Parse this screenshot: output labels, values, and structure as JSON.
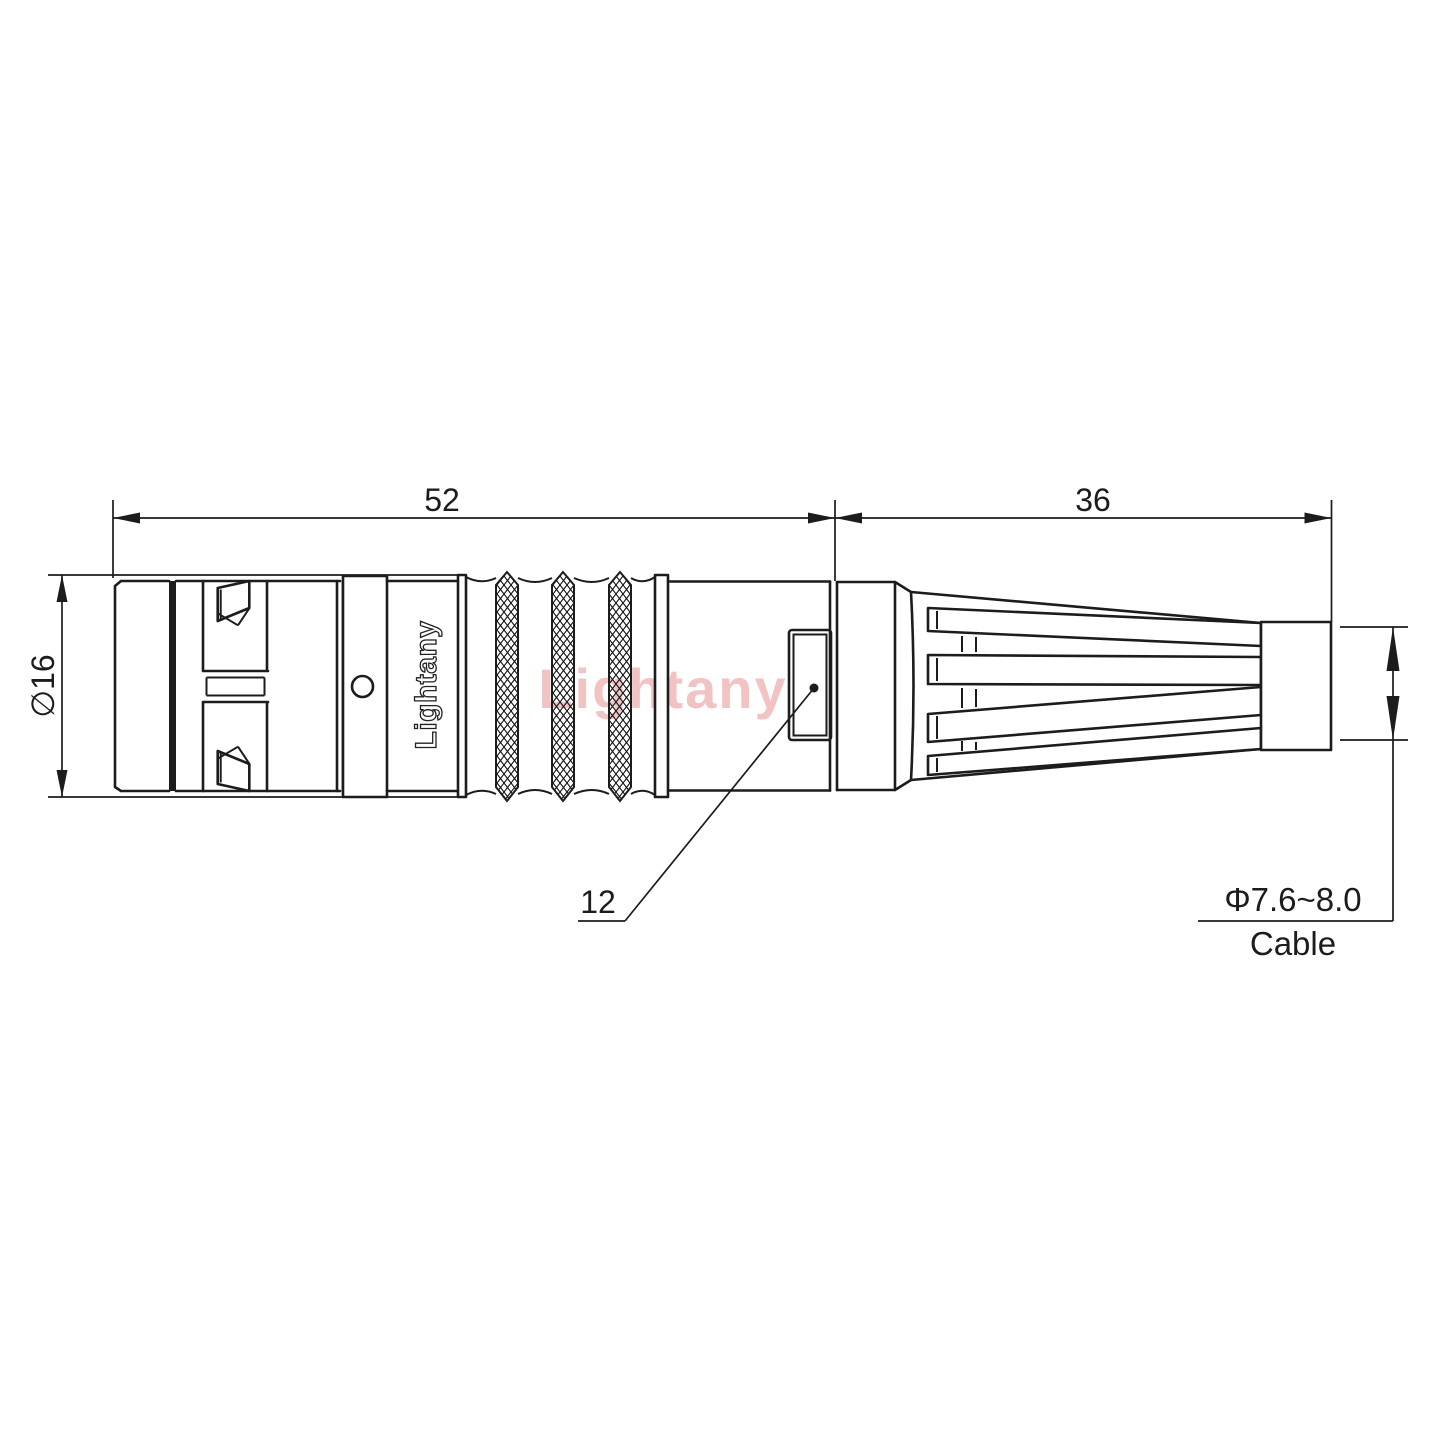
{
  "drawing": {
    "type": "connector-technical-drawing",
    "dims": {
      "front_length": "52",
      "boot_length": "36",
      "diameter": "∅16",
      "insert": "12",
      "cable_diameter": "Φ7.6~8.0",
      "cable_word": "Cable"
    },
    "brand": {
      "marking": "Lightany",
      "watermark": "Lightany"
    },
    "colors": {
      "line": "#1c1c1c",
      "watermark": "#f1c3c3",
      "background": "#ffffff"
    }
  }
}
